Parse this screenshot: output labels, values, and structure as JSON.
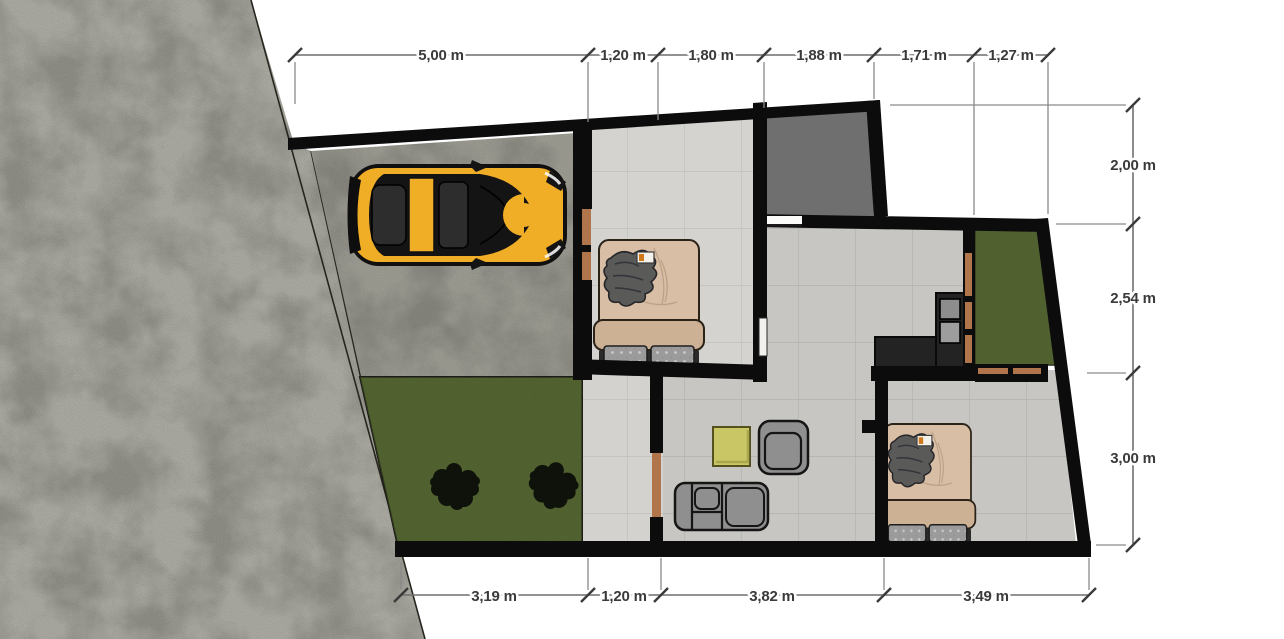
{
  "dimensions": {
    "top": [
      "5,00 m",
      "1,20 m",
      "1,80 m",
      "1,88 m",
      "1,71 m",
      "1,27 m"
    ],
    "right": [
      "2,00 m",
      "2,54 m",
      "3,00 m"
    ],
    "bottom": [
      "3,19 m",
      "1,20 m",
      "3,82 m",
      "3,49 m"
    ],
    "unit": "m"
  },
  "colors": {
    "wall": "#0c0c0c",
    "tile": "#cecdc9",
    "tile_joint": "#b9b8b4",
    "grass": "#57663b",
    "concrete_outdoor": "#a9a8a0",
    "concrete_carport": "#9b9a91",
    "dark_room": "#6f6f6f",
    "car_body": "#f0ad26",
    "bed_duvet": "#d9bea6",
    "bed_blanket": "#ccb195",
    "counter": "#232323",
    "door_wood": "#b0754a",
    "sofa": "#8f8f8f",
    "coffee_table": "#c9c765",
    "dim_line": "#6f6f6f",
    "dim_text": "#3a3a3a",
    "background": "#ffffff"
  }
}
